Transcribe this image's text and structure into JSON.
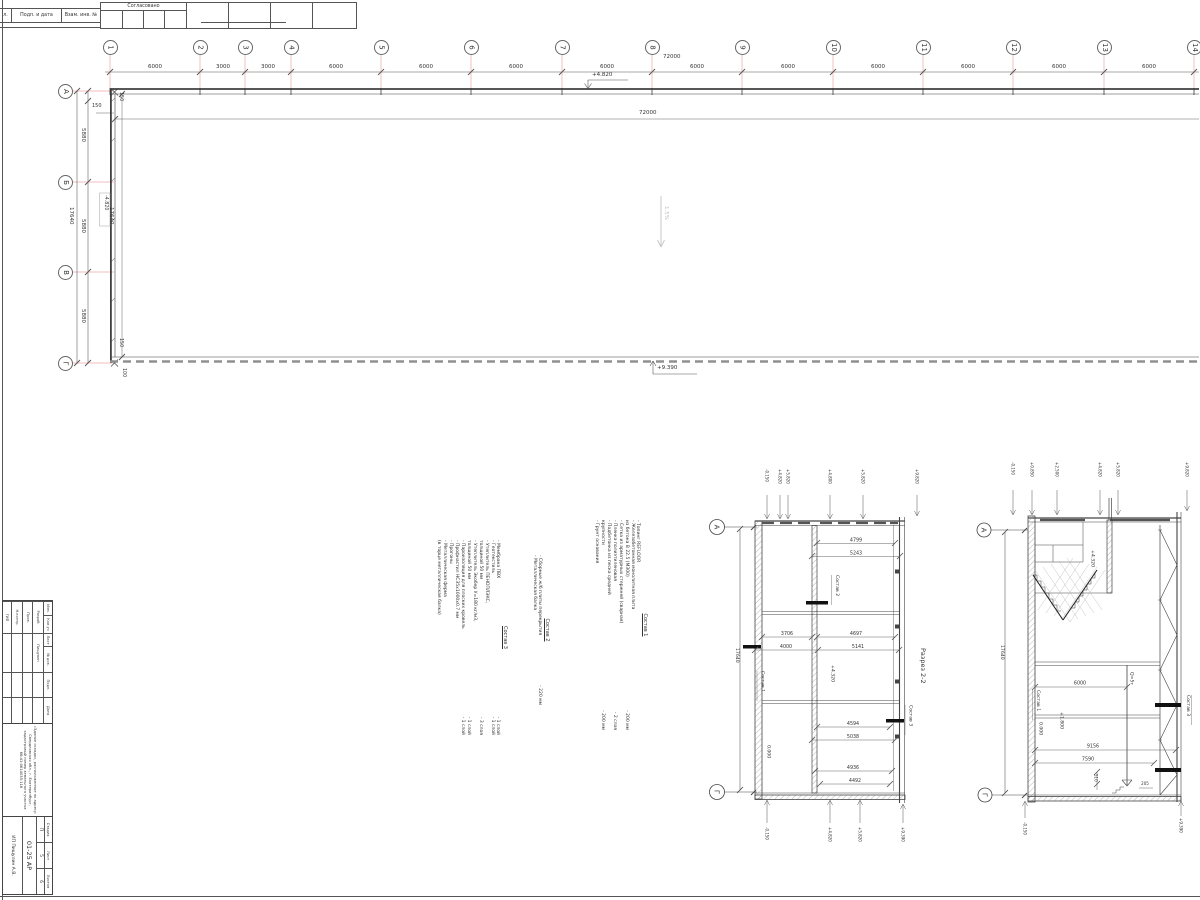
{
  "stamp_top": {
    "col1": "л.",
    "col2": "Подп. и дата",
    "col3": "Взам. инв. №",
    "approved": "Согласовано"
  },
  "plan": {
    "axes_h": [
      "1",
      "2",
      "3",
      "4",
      "5",
      "6",
      "7",
      "8",
      "9",
      "10",
      "11",
      "12",
      "13",
      "14"
    ],
    "dims_h": [
      "6000",
      "3000",
      "3000",
      "6000",
      "6000",
      "6000",
      "6000",
      "6000",
      "6000",
      "6000",
      "6000",
      "6000",
      "6000"
    ],
    "total_h": "72000",
    "inner_h": "72000",
    "axes_v": [
      "А",
      "Б",
      "В",
      "Г"
    ],
    "dims_v": [
      "5880",
      "5880",
      "5880"
    ],
    "total_v": "17640",
    "inner_v": "17640",
    "d150a": "150",
    "d150b": "150",
    "d150c": "150",
    "d100": "100",
    "elev_top": "+4.820",
    "elev_mid": "-4.820",
    "elev_bot": "+9.390",
    "slope": "1.5%"
  },
  "notes": {
    "s1": {
      "title": "Состав 1",
      "items": [
        {
          "t": "- Топинг REFLOOR",
          "v": ""
        },
        {
          "t": "- Железобетонная монолитная плита",
          "v": ""
        },
        {
          "t": "  из бетона В 22.5 (М300)",
          "v": "- 200 мм"
        },
        {
          "t": "- Сетка из арматурных стержней (сварная)",
          "v": ""
        },
        {
          "t": "- Пленка полиэтиленовая",
          "v": "- 2 слоя"
        },
        {
          "t": "- Подбетонка из песка средней",
          "v": ""
        },
        {
          "t": "  крупности",
          "v": "- 200 мм"
        },
        {
          "t": "- Грунт основания",
          "v": ""
        }
      ]
    },
    "s2": {
      "title": "Состав 2",
      "items": [
        {
          "t": "- Сборные ж/б плиты перекрытия",
          "v": "- 220 мм"
        },
        {
          "t": "- Металлическая балка",
          "v": ""
        }
      ]
    },
    "s3": {
      "title": "Состав 3",
      "items": [
        {
          "t": "- Мембрана ПВХ",
          "v": "- 1 слой"
        },
        {
          "t": "- Геотекстиль",
          "v": "- 1 слой"
        },
        {
          "t": "- Утеплитель ПЕНОПЛЭКС,",
          "v": ""
        },
        {
          "t": "  толщиной 50 мм",
          "v": "- 3 слоя"
        },
        {
          "t": "- Утеплитель Экобер У=180 кг/м3,",
          "v": ""
        },
        {
          "t": "  толщиной 50 мм",
          "v": "- 1 слой"
        },
        {
          "t": "- Пароизоляция для плоских кровель",
          "v": "- 1 слой"
        },
        {
          "t": "- Профнастил НС35х1000х0.7 мм",
          "v": ""
        },
        {
          "t": "- Прогоны",
          "v": ""
        },
        {
          "t": "- Металлическая ферма",
          "v": ""
        },
        {
          "t": "(в торце металлическая балка)",
          "v": ""
        }
      ]
    }
  },
  "sections": {
    "title": "Разрез 2-2",
    "s1": {
      "axis_top": "А",
      "axis_bot": "Г",
      "total": "17640",
      "d1": "4799",
      "d2": "5243",
      "d3": "3706",
      "d4": "4697",
      "d5": "4000",
      "d6": "5141",
      "d7": "4594",
      "d8": "5038",
      "d9": "4936",
      "d10": "4492",
      "lbl_s1": "Состав 1",
      "lbl_s2": "Состав 2",
      "lbl_s3": "Состав 3",
      "elev_0": "0.000",
      "elev_43": "+4.320",
      "top_marks": [
        "-0.150",
        "+4.820",
        "+5.820",
        "+4.800",
        "+5.820",
        "+9.820"
      ],
      "bot_marks": [
        "-0.150",
        "+4.820",
        "+5.820",
        "+9.390"
      ]
    },
    "s2": {
      "axis_top": "А",
      "axis_bot": "Г",
      "total": "17640",
      "d6000": "6000",
      "d9156": "9156",
      "d7590": "7590",
      "d510": "510",
      "d205": "205",
      "crane": "Q=5т",
      "lbl_s1": "Состав 1",
      "lbl_s3": "Состав 3",
      "elev_0": "0.000",
      "elev_18": "+1.800",
      "elev_43": "+4.320",
      "top_marks": [
        "-0.150",
        "+0.850",
        "+2.500",
        "+4.820",
        "+5.820",
        "+9.820"
      ],
      "bot_left": "-0.150",
      "bot_right": "+9.390"
    }
  },
  "title_block": {
    "h1": "Изм.",
    "h2": "Кол.уч",
    "h3": "Лист",
    "h4": "№ док.",
    "h5": "Подп.",
    "h6": "Дата",
    "r1": "Разраб.",
    "r1n": "Пищулин",
    "r2": "Пров.",
    "r3": "Н.контр.",
    "r4": "ГИП",
    "project": "«Здание склада», расположенное по адресу: Свердловская обл., г. Екатеринбург, кадастровый номер земельного участка 66:41:0614035:116",
    "code": "01-25 АР",
    "stage_l": "Стадия",
    "list_l": "Лист",
    "lists_l": "Листов",
    "stage": "П",
    "list": "5",
    "lists": "6",
    "org": "ИП Пищулин А.В."
  }
}
